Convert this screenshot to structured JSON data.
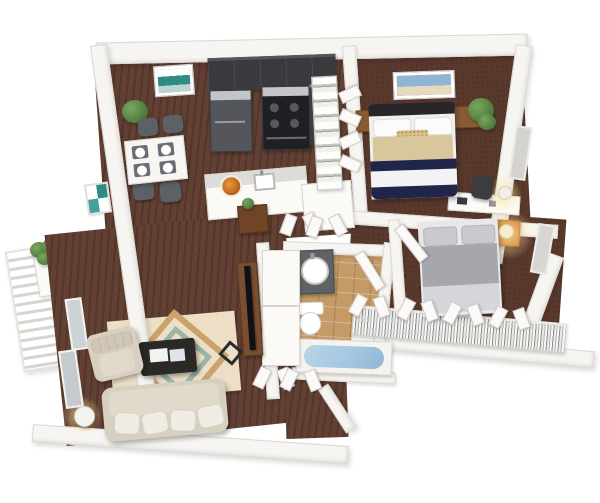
{
  "meta": {
    "title": "3D dollhouse floor plan rendering of an apartment",
    "view": "top-down perspective render, white background",
    "visible_text": "none"
  },
  "palette": {
    "background": "#ffffff",
    "wall_white": "#f7f5f1",
    "wall_edge": "#dcd8d1",
    "floor_carpet_brown": "#5d3b2e",
    "bathroom_tile_tan": "#c49a66",
    "kitchen_cabinet_charcoal": "#3a3a3e",
    "appliance_black": "#1f2023",
    "appliance_silver": "#c3c6c9",
    "sofa_beige": "#d7cfc0",
    "bed_navy": "#20264a",
    "bed_khaki": "#d8c69c",
    "bed2_gray": "#a6a6ac",
    "nightstand_wood": "#8a5a34",
    "nightstand_orange": "#c8732c",
    "tub_blue": "#a3c6e0",
    "rug_cream": "#ecdfc6",
    "rug_tan": "#c9a36b",
    "rug_teal": "#9bb5a8",
    "plant_green": "#55813f",
    "art_teal": "#2e8b85"
  },
  "rooms": [
    {
      "name": "Balcony",
      "items": [
        "white railing",
        "planter box",
        "green plants"
      ]
    },
    {
      "name": "Dining Area",
      "items": [
        "white dining table with four place settings",
        "four gray chairs",
        "potted plant",
        "teal wall art"
      ]
    },
    {
      "name": "Kitchen",
      "items": [
        "charcoal upper cabinets",
        "refrigerator",
        "range oven",
        "counter peninsula",
        "sink",
        "orange fruit bowl",
        "white pantry shelving"
      ]
    },
    {
      "name": "Master Bedroom",
      "items": [
        "bed with navy/white/khaki bedding",
        "dark headboard",
        "two wood nightstands",
        "beach wall art",
        "potted plant",
        "desk",
        "dark office chair",
        "white lamp",
        "window",
        "bifold closet doors"
      ]
    },
    {
      "name": "Bedroom 2",
      "items": [
        "bed with gray bedding",
        "orange nightstand",
        "lit table lamp",
        "closet with hanging clothes",
        "open bifold closet doors",
        "window"
      ]
    },
    {
      "name": "Bathroom",
      "items": [
        "vanity with round sink",
        "toilet",
        "blue bathtub",
        "tan tile floor",
        "open door"
      ]
    },
    {
      "name": "Hallway",
      "items": [
        "storage closets",
        "open bifold doors",
        "wood console table",
        "small plant"
      ]
    },
    {
      "name": "Living Room",
      "items": [
        "beige sofa with pillows",
        "beige armchair",
        "dark coffee table with magazines",
        "geometric area rug",
        "flat TV",
        "wood TV console",
        "round side table",
        "lamp",
        "sliding balcony door"
      ]
    },
    {
      "name": "Entry",
      "items": [
        "angled entry wall",
        "open front door"
      ]
    }
  ]
}
